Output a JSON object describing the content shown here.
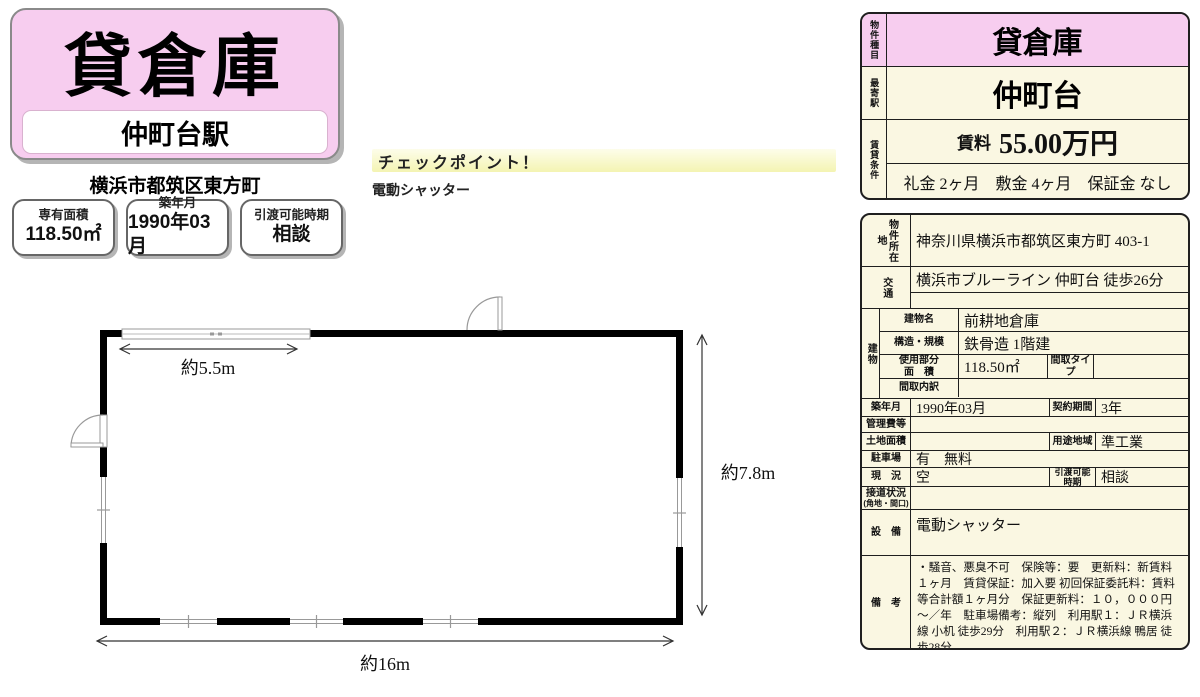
{
  "colors": {
    "pink": "#f7cdef",
    "cream": "#faf7e2"
  },
  "title_card": {
    "property_type": "貸倉庫",
    "station": "仲町台駅",
    "address": "横浜市都筑区東方町"
  },
  "summary": {
    "boxes": [
      {
        "label": "専有面積",
        "value": "118.50㎡"
      },
      {
        "label": "築年月",
        "value": "1990年03月"
      },
      {
        "label": "引渡可能時期",
        "value": "相談"
      }
    ]
  },
  "checkpoint": {
    "title": "チェックポイント！",
    "item": "電動シャッター"
  },
  "floorplan": {
    "width_label": "約16m",
    "depth_label": "約7.8m",
    "shutter_label": "約5.5m"
  },
  "header_table": {
    "type_label": "物件種目",
    "type_value": "貸倉庫",
    "station_label": "最寄駅",
    "station_value": "仲町台",
    "terms_label": "賃貸条件",
    "rent_label": "賃料",
    "rent_value": "55.00万円",
    "terms_value": "礼金 2ヶ月　敷金 4ヶ月　保証金 なし"
  },
  "detail_table": {
    "location_label": "物件所在地",
    "location_value": "神奈川県横浜市都筑区東方町 403-1",
    "access_label": "交通",
    "access_value": "横浜市ブルーライン 仲町台 徒歩26分",
    "access_value2": "",
    "building_label": "建物",
    "building_name_label": "建物名",
    "building_name": "前耕地倉庫",
    "structure_label": "構造・規模",
    "structure": "鉄骨造 1階建",
    "area_label_1": "使用部分",
    "area_label_2": "面　積",
    "area_value": "118.50㎡",
    "madori_type_label": "間取タイプ",
    "madori_type": "",
    "madori_detail_label": "間取内訳",
    "madori_detail": "",
    "built_label": "築年月",
    "built_value": "1990年03月",
    "contract_label": "契約期間",
    "contract_value": "3年",
    "mgmt_label": "管理費等",
    "mgmt_value": "",
    "land_label": "土地面積",
    "land_value": "",
    "zoning_label": "用途地域",
    "zoning_value": "準工業",
    "parking_label": "駐車場",
    "parking_value": "有　無料",
    "status_label": "現　況",
    "status_value": "空",
    "handover_label_1": "引渡可能",
    "handover_label_2": "時期",
    "handover_value": "相談",
    "road_label": "接道状況",
    "road_label_sub": "(角地・間口)",
    "road_value": "",
    "equipment_label": "設　備",
    "equipment_value": "電動シャッター",
    "remarks_label": "備　考",
    "remarks_value": "・騒音、悪臭不可　保険等：要　更新料：新賃料１ヶ月　賃貸保証：加入要 初回保証委託料：賃料等合計額１ヶ月分　保証更新料：１０，０００円～／年　駐車場備考：縦列　利用駅１：ＪＲ横浜線 小机 徒歩29分　利用駅２：ＪＲ横浜線 鴨居 徒歩28分"
  }
}
